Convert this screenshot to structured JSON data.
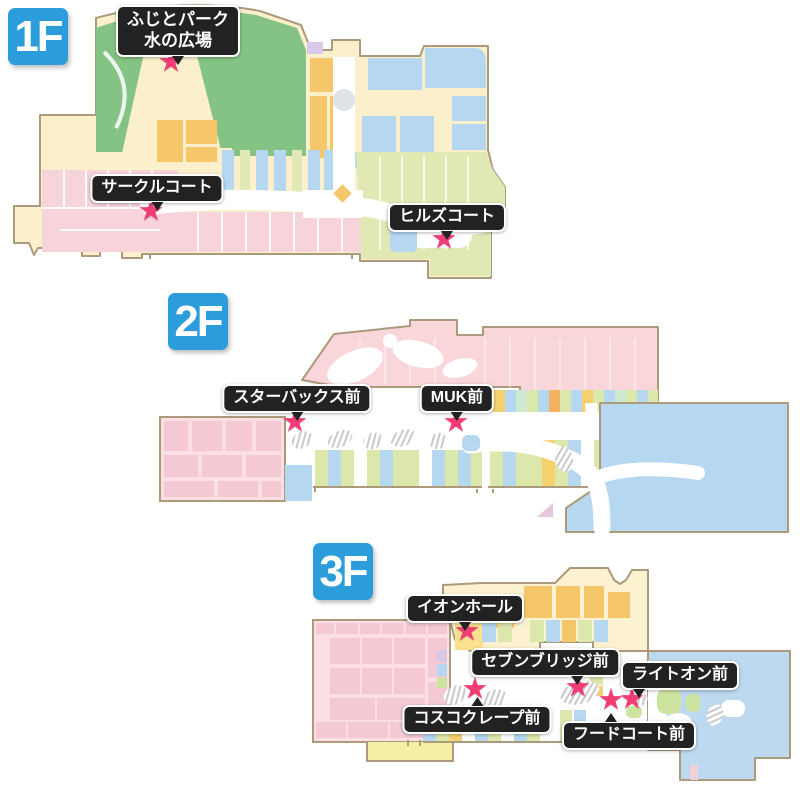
{
  "floors": [
    {
      "badge": "1F",
      "markers": [
        {
          "label": "ふじとパーク\n水の広場"
        },
        {
          "label": "サークルコート"
        },
        {
          "label": "ヒルズコート"
        }
      ]
    },
    {
      "badge": "2F",
      "markers": [
        {
          "label": "スターバックス前"
        },
        {
          "label": "MUK前"
        }
      ]
    },
    {
      "badge": "3F",
      "markers": [
        {
          "label": "イオンホール"
        },
        {
          "label": "セブンブリッジ前"
        },
        {
          "label": "ライトオン前"
        },
        {
          "label": "コスコクレープ前"
        },
        {
          "label": "フードコート前"
        }
      ]
    }
  ],
  "icons": {
    "marker_star": "★"
  },
  "colors": {
    "floor_badge_blue": "#2d9cdb",
    "label_bg": "#222222",
    "label_text": "#ffffff",
    "star_pink": "#f23c74",
    "map_outline_tan": "#ab9b7c",
    "map_cream": "#fcf0cc",
    "park_green": "#84c384",
    "shop_orange": "#f6c66a",
    "shop_blue": "#b5d7f0",
    "shop_pink": "#f7d3da",
    "shop_olive": "#e0e8b4",
    "shop_lavender": "#d9c9e8",
    "shop_yellow": "#f6cf6e"
  }
}
